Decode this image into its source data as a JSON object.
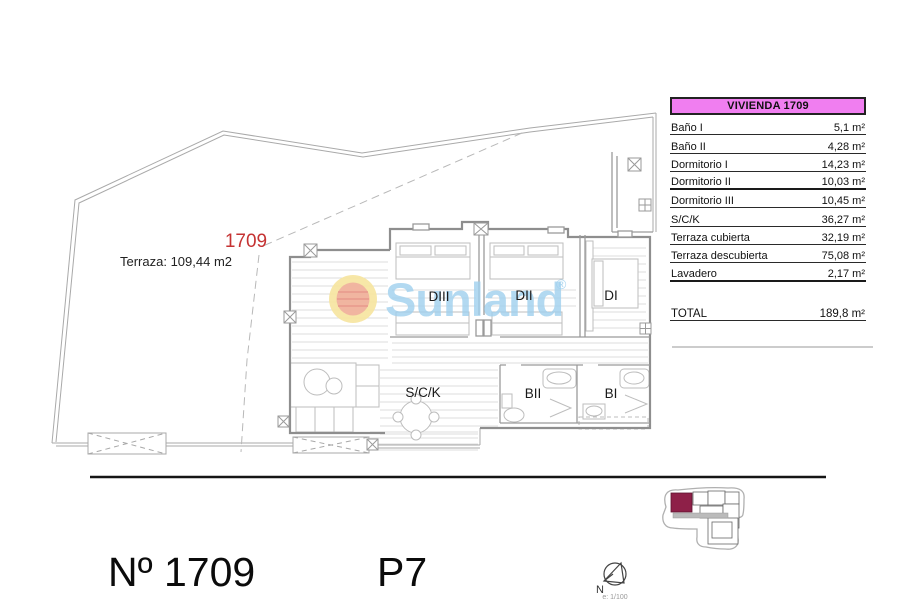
{
  "plan": {
    "unit_label": "1709",
    "terrace_label": "Terraza: 109,44 m2",
    "rooms": [
      {
        "label": "DIII"
      },
      {
        "label": "DII"
      },
      {
        "label": "DI"
      },
      {
        "label": "S/C/K"
      },
      {
        "label": "BII"
      },
      {
        "label": "BI"
      }
    ]
  },
  "watermark": {
    "brand": "Sunland",
    "registered_mark": "®"
  },
  "area_table": {
    "header": "VIVIENDA 1709",
    "rows": [
      {
        "label": "Baño I",
        "value": "5,1 m²"
      },
      {
        "label": "Baño II",
        "value": "4,28 m²"
      },
      {
        "label": "Dormitorio I",
        "value": "14,23 m²"
      },
      {
        "label": "Dormitorio II",
        "value": "10,03 m²"
      },
      {
        "label": "Dormitorio III",
        "value": "10,45 m²"
      },
      {
        "label": "S/C/K",
        "value": "36,27 m²"
      },
      {
        "label": "Terraza cubierta",
        "value": "32,19 m²"
      },
      {
        "label": "Terraza descubierta",
        "value": "75,08 m²"
      },
      {
        "label": "Lavadero",
        "value": "2,17 m²"
      }
    ],
    "total": {
      "label": "TOTAL",
      "value": "189,8 m²"
    }
  },
  "footer": {
    "unit_number": "Nº 1709",
    "floor": "P7"
  },
  "compass": {
    "north_label": "N",
    "scale_label": "e: 1/100"
  },
  "colors": {
    "unit_red": "#C53333",
    "table_header_bg": "#F07EF0",
    "watermark_blue": "#9FD0EE",
    "sun_outer_yellow": "#F6E49E",
    "sun_inner_salmon": "#EFAF9F",
    "keyplan_highlight": "#8E2048"
  }
}
